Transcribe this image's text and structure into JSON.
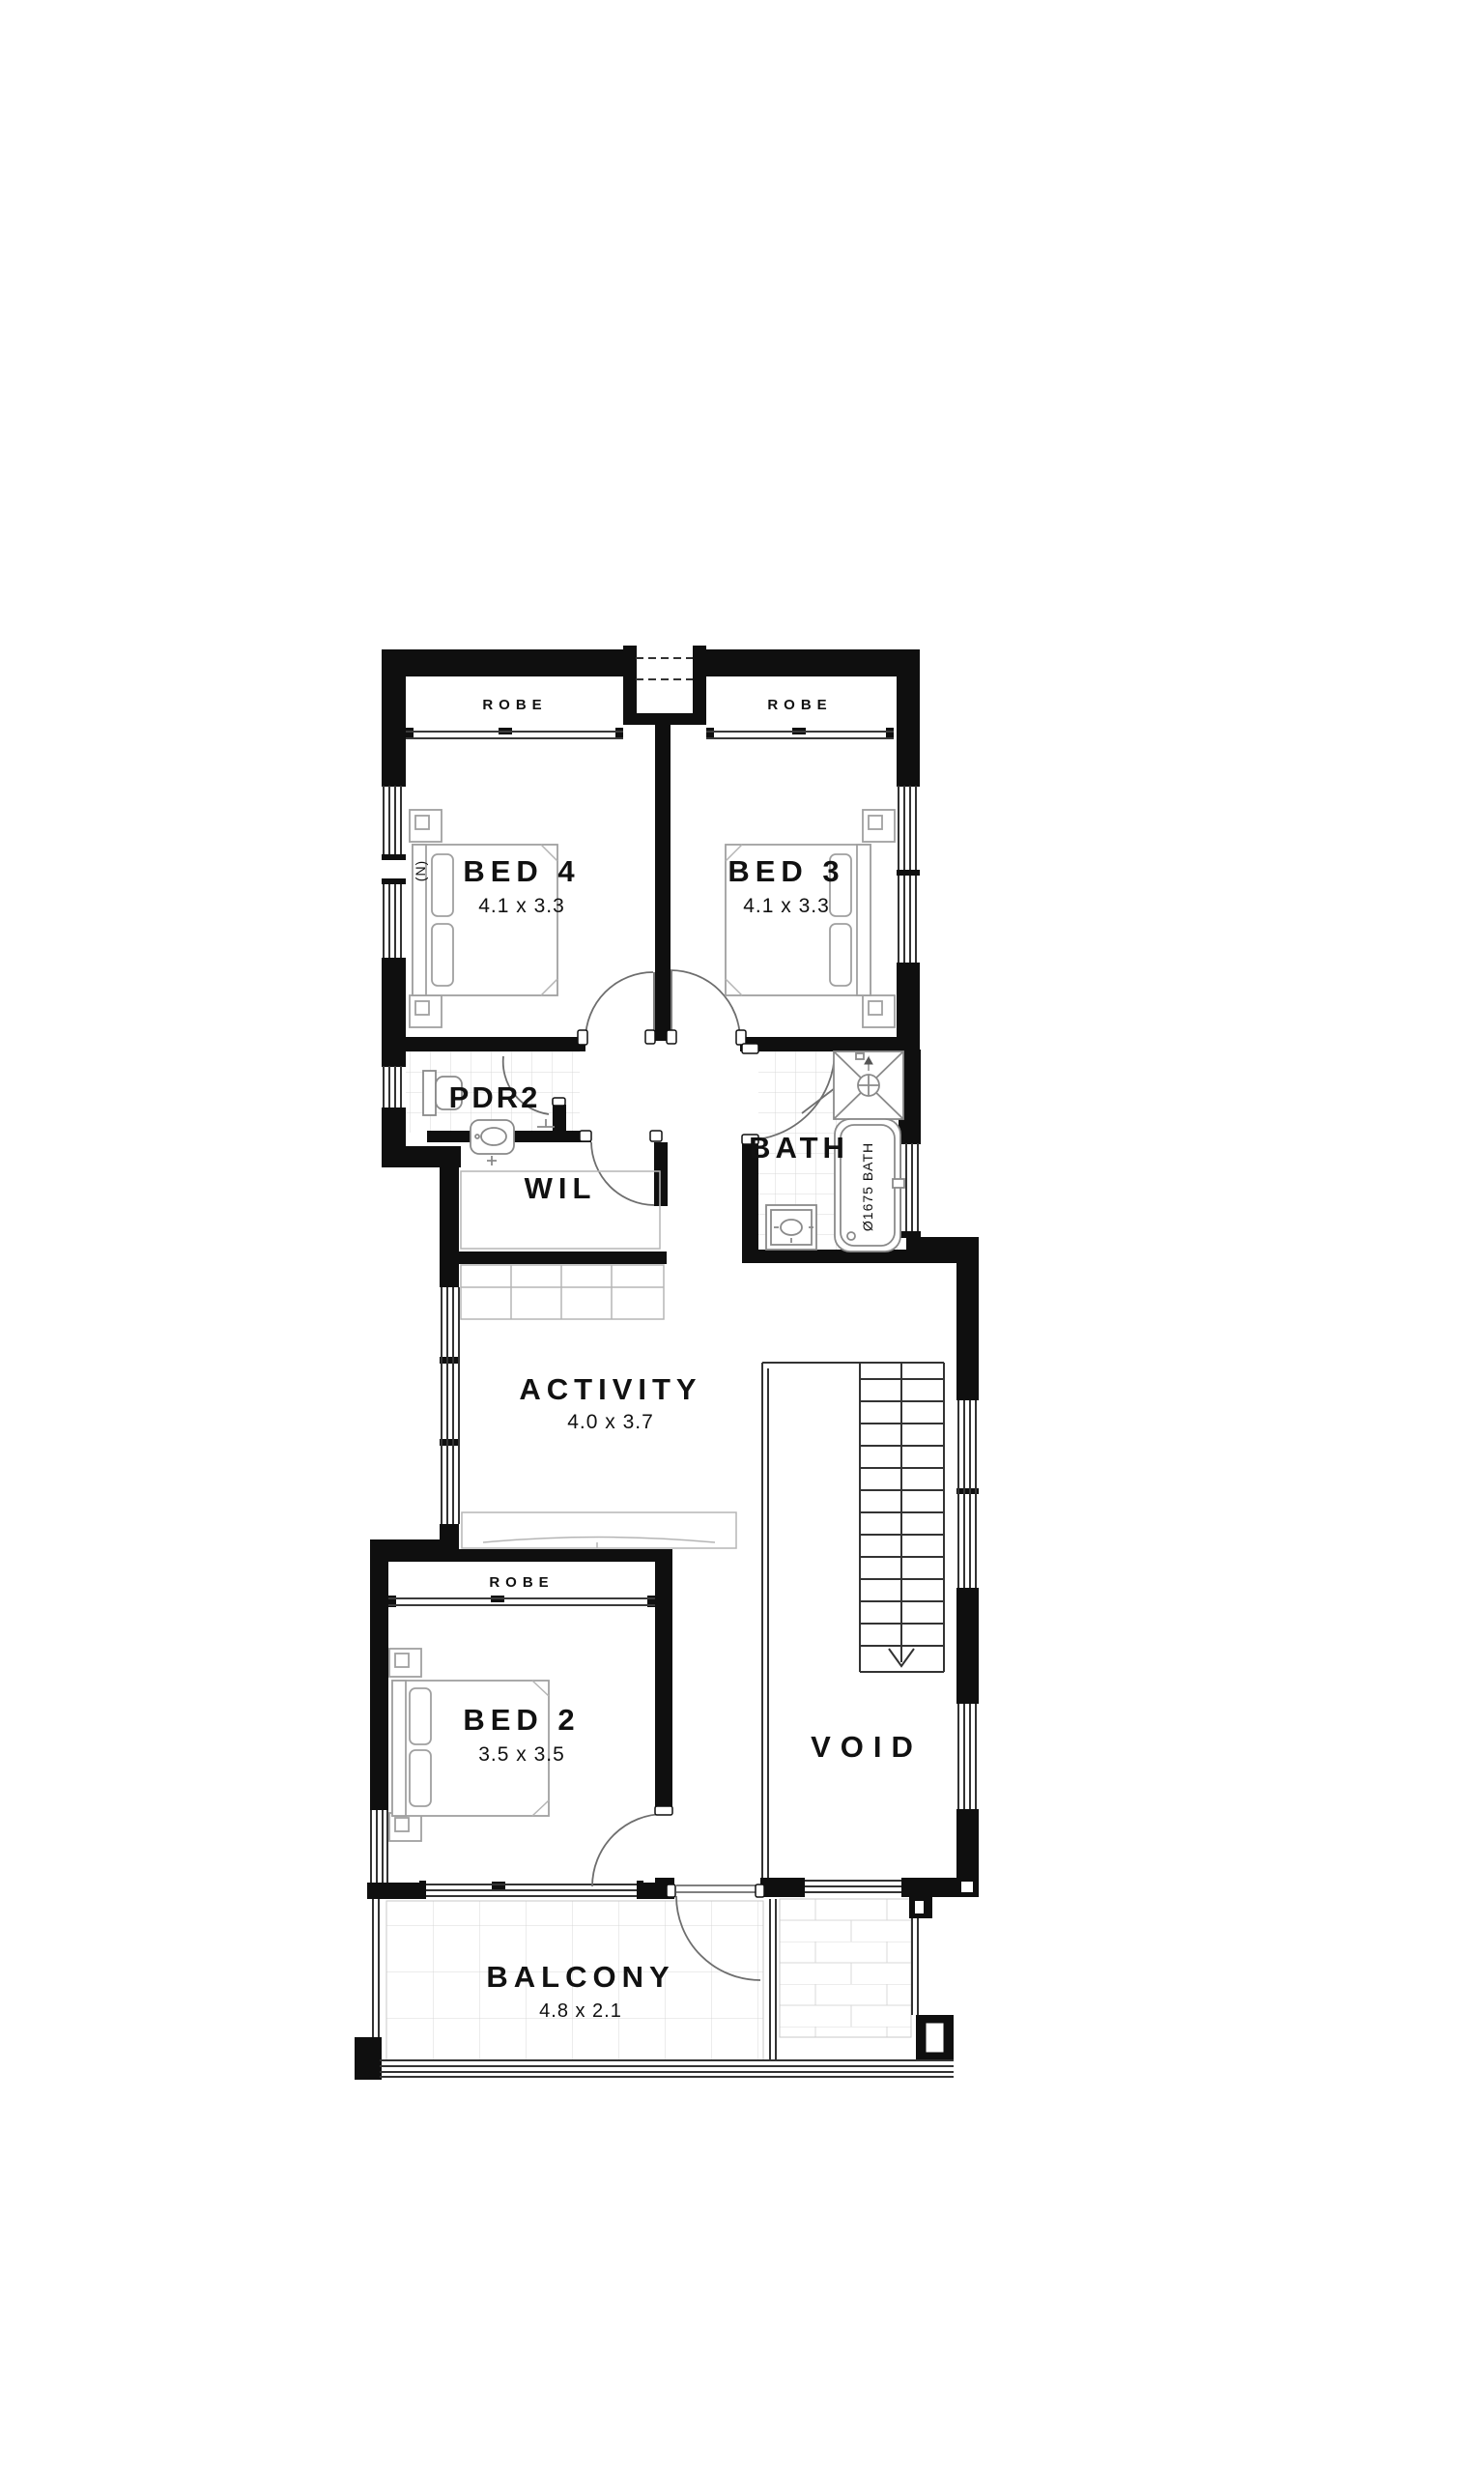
{
  "plan": {
    "rooms": {
      "bed4": {
        "label": "BED 4",
        "dims": "4.1 x 3.3"
      },
      "bed3": {
        "label": "BED 3",
        "dims": "4.1 x 3.3"
      },
      "bed2": {
        "label": "BED 2",
        "dims": "3.5 x 3.5"
      },
      "activity": {
        "label": "ACTIVITY",
        "dims": "4.0 x 3.7"
      },
      "balcony": {
        "label": "BALCONY",
        "dims": "4.8 x 2.1"
      },
      "pdr2": {
        "label": "PDR2"
      },
      "wil": {
        "label": "WIL"
      },
      "bath": {
        "label": "BATH"
      },
      "void": {
        "label": "VOID"
      }
    },
    "labels": {
      "robe": "ROBE"
    },
    "fixtures": {
      "tub_label": "Ø1675 BATH"
    },
    "markers": {
      "window_note": "(N)"
    },
    "colors": {
      "wall": "#0f0f0f",
      "tile": "#d8d8d8",
      "fixture": "#8a8a8a",
      "text": "#111111",
      "background": "#ffffff"
    }
  }
}
